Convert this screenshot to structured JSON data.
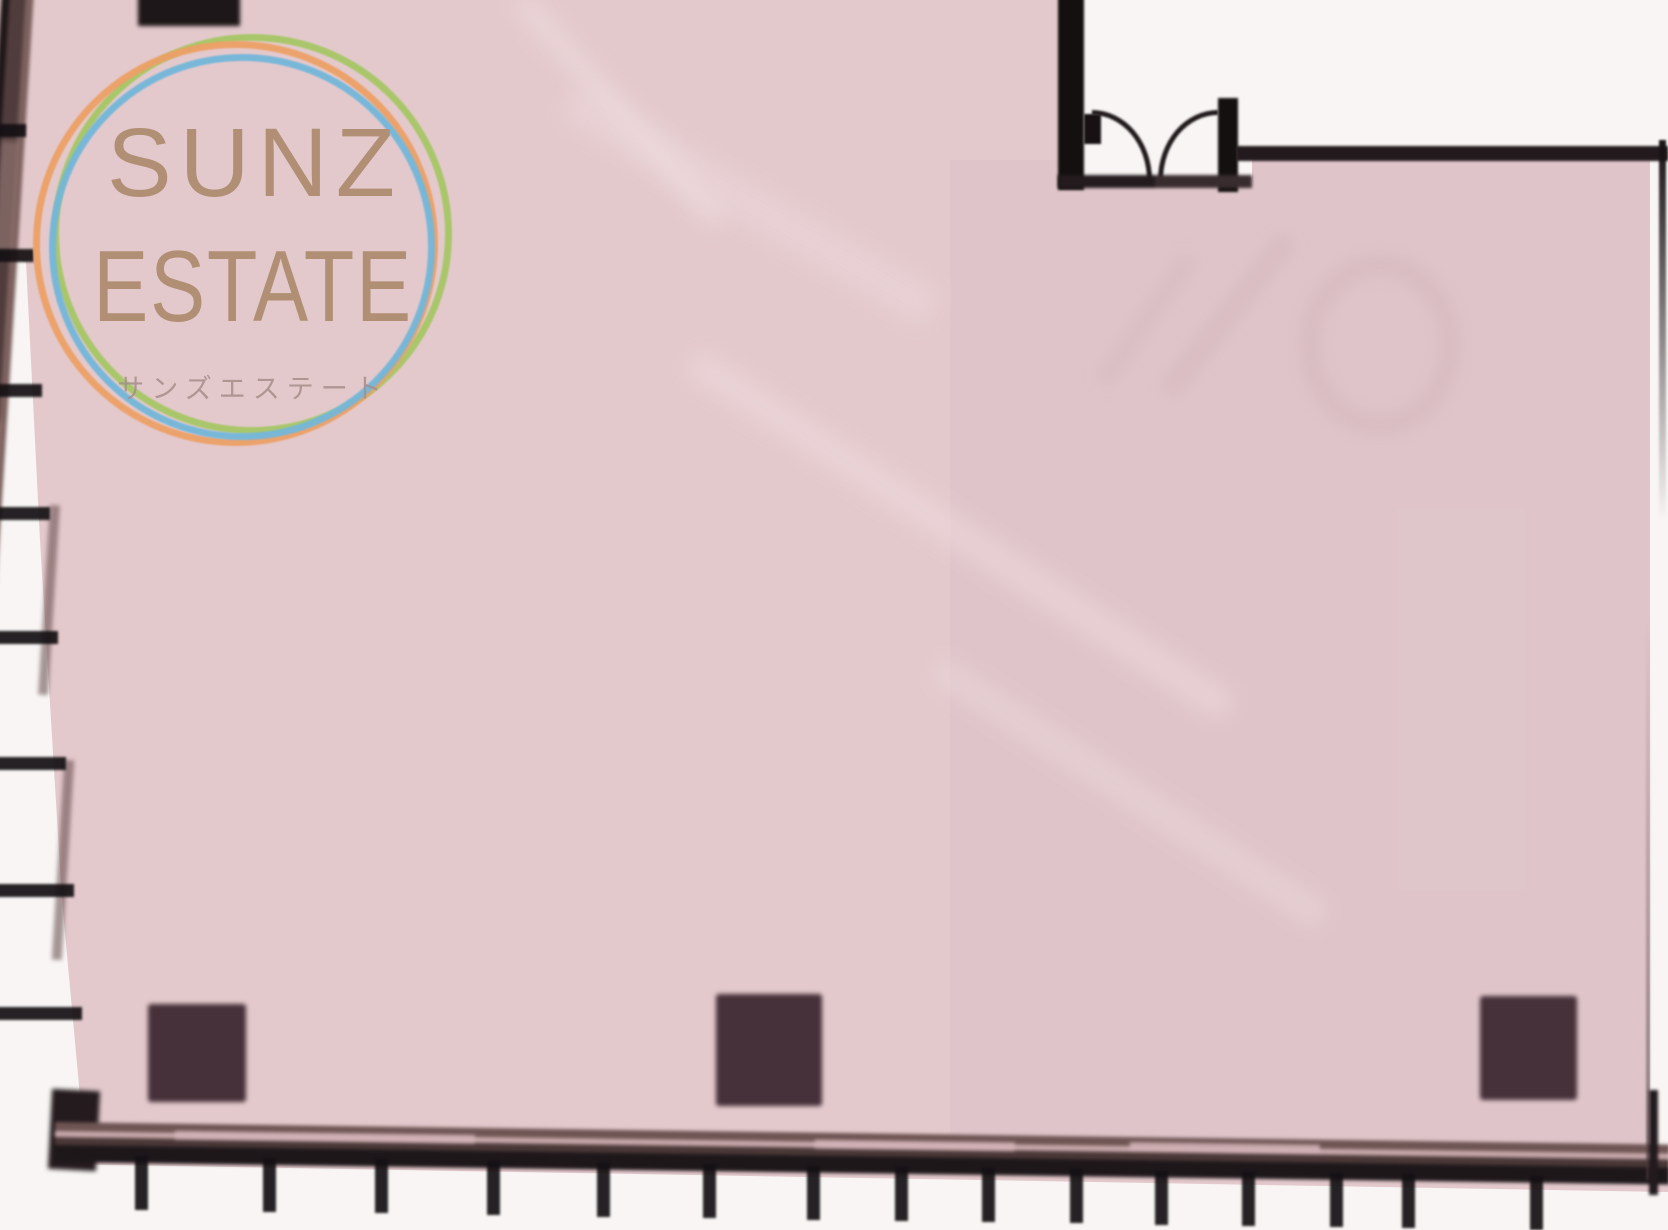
{
  "logo": {
    "title_line1": "SUNZ",
    "title_line2": "ESTATE",
    "subtitle": "サンズエステート",
    "text_color": "#b18f74",
    "subtitle_color": "#a58f8a",
    "ring_colors": {
      "orange": "#eda066",
      "blue": "#74b7da",
      "green": "#a6c765"
    }
  },
  "floorplan": {
    "description": "empty room floor plan",
    "floor_color": "#e3c9cc",
    "wall_color": "#221a1d",
    "pillar_color": "#463039",
    "exterior_color": "#f8f5f4",
    "pillar_count": 3,
    "door": {
      "type": "double-swing-door",
      "location": "top-right"
    }
  }
}
